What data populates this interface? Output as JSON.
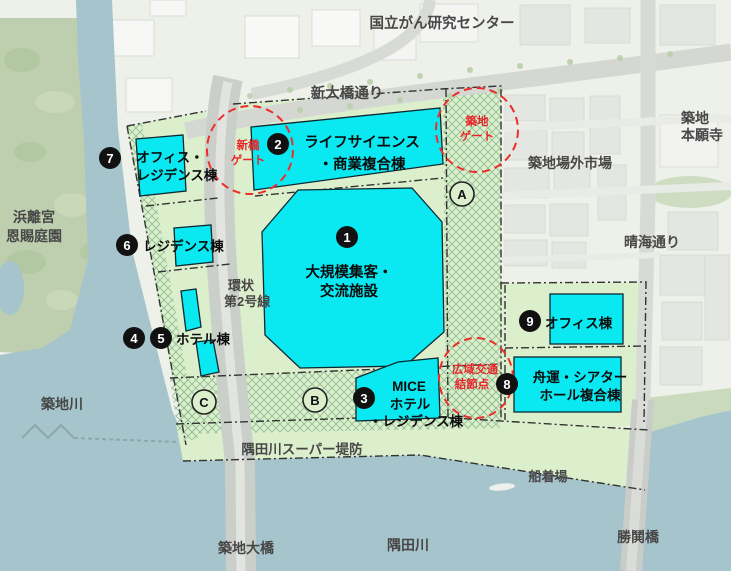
{
  "colors": {
    "building_cyan": "#0ae9f2",
    "site_green": "#dcefcd",
    "hatch_green": "#8fbd92",
    "water_blue": "#a5c4cc",
    "park_green": "#bdcfae",
    "city_grey": "#eef0ea",
    "gate_red": "#e8262a",
    "boundary_dark": "#333333"
  },
  "markers": {
    "m1": "1",
    "m2": "2",
    "m3": "3",
    "m4": "4",
    "m5": "5",
    "m6": "6",
    "m7": "7",
    "m8": "8",
    "m9": "9"
  },
  "zones": {
    "a": "A",
    "b": "B",
    "c": "C"
  },
  "gates": {
    "shimbashi": {
      "lines": [
        "新橋",
        "ゲート"
      ]
    },
    "tsukiji": {
      "lines": [
        "築地",
        "ゲート"
      ]
    },
    "hub": {
      "lines": [
        "広域交通",
        "結節点"
      ]
    }
  },
  "buildings": {
    "b1": {
      "lines": [
        "大規模集客・",
        "交流施設"
      ]
    },
    "b2": {
      "lines": [
        "ライフサイエンス",
        "・商業複合棟"
      ]
    },
    "b3": {
      "lines": [
        "MICE",
        "ホテル",
        "・レジデンス棟"
      ]
    },
    "b45": {
      "lines": [
        "ホテル棟"
      ]
    },
    "b6": {
      "lines": [
        "レジデンス棟"
      ]
    },
    "b7": {
      "lines": [
        "オフィス・",
        "レジデンス棟"
      ]
    },
    "b8": {
      "lines": [
        "舟運・シアター",
        "ホール複合棟"
      ]
    },
    "b9": {
      "lines": [
        "オフィス棟"
      ]
    }
  },
  "surroundings": {
    "cancer_center": "国立がん研究センター",
    "shin_ohashi": "新大橋通り",
    "honganji": {
      "lines": [
        "築地",
        "本願寺"
      ]
    },
    "jogai_market": "築地場外市場",
    "harumi_dori": "晴海通り",
    "hamarikyu": {
      "lines": [
        "浜離宮",
        "恩賜庭園"
      ]
    },
    "tsukiji_river": "築地川",
    "kanjo2": {
      "lines": [
        "環状",
        "第2号線"
      ]
    },
    "super_levee": "隅田川スーパー堤防",
    "tsukiji_bridge": "築地大橋",
    "sumida_river": "隅田川",
    "pier": "船着場",
    "kachidoki_bridge": "勝鬨橋"
  }
}
